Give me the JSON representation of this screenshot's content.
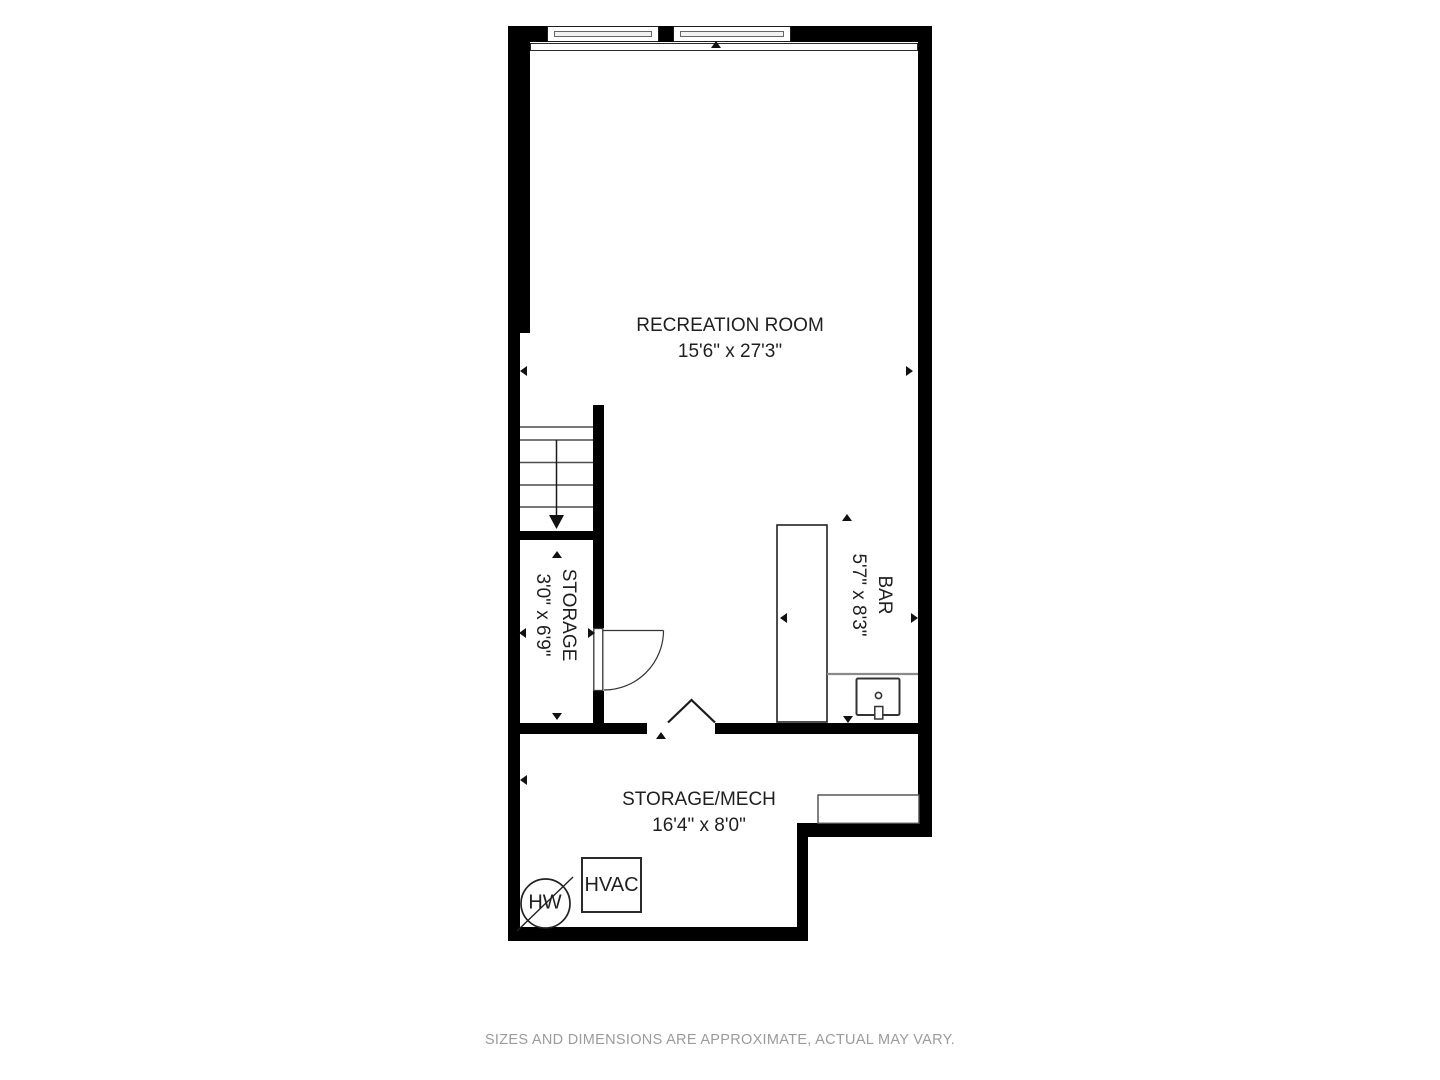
{
  "plan": {
    "rooms": [
      {
        "name": "RECREATION ROOM",
        "dims": "15'6\" x 27'3\""
      },
      {
        "name": "STORAGE",
        "dims": "3'0\" x 6'9\""
      },
      {
        "name": "BAR",
        "dims": "5'7\" x 8'3\""
      },
      {
        "name": "STORAGE/MECH",
        "dims": "16'4\" x 8'0\""
      }
    ],
    "fixtures": {
      "hvac_label": "HVAC",
      "water_heater_label": "HW"
    },
    "colors": {
      "wall": "#000000",
      "line": "#333333",
      "text": "#1f1f1f",
      "muted_text": "#9b9b9b"
    }
  },
  "footer": {
    "disclaimer": "SIZES AND DIMENSIONS ARE APPROXIMATE, ACTUAL MAY VARY."
  }
}
